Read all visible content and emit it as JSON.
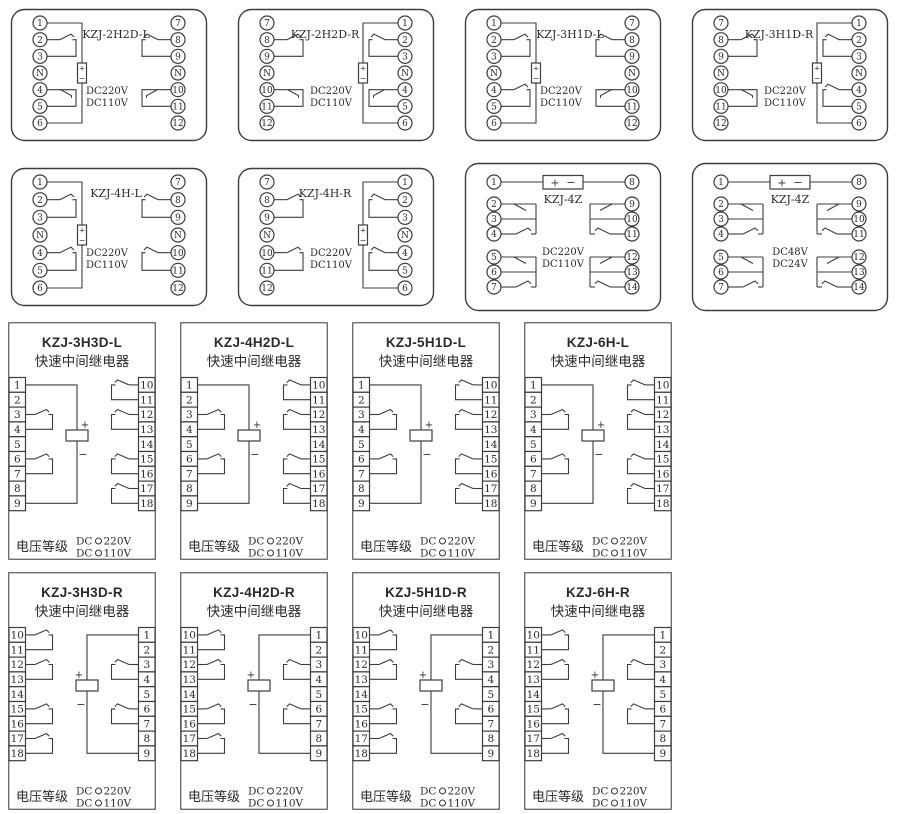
{
  "page": {
    "background": "#ffffff",
    "line_color": "#3c3c3c",
    "text_color": "#2b2b2b"
  },
  "rows": [
    {
      "y": 8,
      "xs": [
        10,
        237,
        464,
        691
      ],
      "panels": [
        {
          "kind": "round",
          "orient": "L",
          "w": 198,
          "h": 134,
          "dy": 0,
          "title": "KZJ-2H2D-L",
          "voltages": [
            "DC220V",
            "DC110V"
          ],
          "left_terminals": [
            "1",
            "2",
            "3",
            "N",
            "4",
            "5",
            "6"
          ],
          "right_terminals": [
            "7",
            "8",
            "9",
            "N",
            "10",
            "11",
            "12"
          ],
          "left_contacts": [
            {
              "rows": [
                1,
                2
              ],
              "type": "no"
            },
            {
              "rows": [
                4,
                5
              ],
              "type": "nc"
            }
          ],
          "right_contacts": [
            {
              "rows": [
                1,
                2
              ],
              "type": "no"
            },
            {
              "rows": [
                4,
                5
              ],
              "type": "nc"
            }
          ]
        },
        {
          "kind": "round",
          "orient": "R",
          "w": 198,
          "h": 134,
          "dy": 0,
          "title": "KZJ-2H2D-R",
          "voltages": [
            "DC220V",
            "DC110V"
          ],
          "left_terminals": [
            "7",
            "8",
            "9",
            "N",
            "10",
            "11",
            "12"
          ],
          "right_terminals": [
            "1",
            "2",
            "3",
            "N",
            "4",
            "5",
            "6"
          ],
          "left_contacts": [
            {
              "rows": [
                1,
                2
              ],
              "type": "no"
            },
            {
              "rows": [
                4,
                5
              ],
              "type": "nc"
            }
          ],
          "right_contacts": [
            {
              "rows": [
                1,
                2
              ],
              "type": "no"
            },
            {
              "rows": [
                4,
                5
              ],
              "type": "nc"
            }
          ]
        },
        {
          "kind": "round",
          "orient": "L",
          "w": 198,
          "h": 134,
          "dy": 0,
          "title": "KZJ-3H1D-L",
          "voltages": [
            "DC220V",
            "DC110V"
          ],
          "left_terminals": [
            "1",
            "2",
            "3",
            "N",
            "4",
            "5",
            "6"
          ],
          "right_terminals": [
            "7",
            "8",
            "9",
            "N",
            "10",
            "11",
            "12"
          ],
          "left_contacts": [
            {
              "rows": [
                1,
                2
              ],
              "type": "no"
            },
            {
              "rows": [
                4,
                5
              ],
              "type": "no"
            }
          ],
          "right_contacts": [
            {
              "rows": [
                1,
                2
              ],
              "type": "no"
            },
            {
              "rows": [
                4,
                5
              ],
              "type": "nc"
            }
          ]
        },
        {
          "kind": "round",
          "orient": "R",
          "w": 198,
          "h": 134,
          "dy": 0,
          "title": "KZJ-3H1D-R",
          "voltages": [
            "DC220V",
            "DC110V"
          ],
          "left_terminals": [
            "7",
            "8",
            "9",
            "N",
            "10",
            "11",
            "12"
          ],
          "right_terminals": [
            "1",
            "2",
            "3",
            "N",
            "4",
            "5",
            "6"
          ],
          "left_contacts": [
            {
              "rows": [
                1,
                2
              ],
              "type": "no"
            },
            {
              "rows": [
                4,
                5
              ],
              "type": "nc"
            }
          ],
          "right_contacts": [
            {
              "rows": [
                1,
                2
              ],
              "type": "no"
            },
            {
              "rows": [
                4,
                5
              ],
              "type": "no"
            }
          ]
        }
      ]
    },
    {
      "y": 162,
      "xs": [
        10,
        237,
        464,
        691
      ],
      "panels": [
        {
          "kind": "round",
          "orient": "L",
          "w": 198,
          "h": 140,
          "dy": 5,
          "title": "KZJ-4H-L",
          "voltages": [
            "DC220V",
            "DC110V"
          ],
          "left_terminals": [
            "1",
            "2",
            "3",
            "N",
            "4",
            "5",
            "6"
          ],
          "right_terminals": [
            "7",
            "8",
            "9",
            "N",
            "10",
            "11",
            "12"
          ],
          "left_contacts": [
            {
              "rows": [
                1,
                2
              ],
              "type": "no"
            },
            {
              "rows": [
                4,
                5
              ],
              "type": "no"
            }
          ],
          "right_contacts": [
            {
              "rows": [
                1,
                2
              ],
              "type": "no"
            },
            {
              "rows": [
                4,
                5
              ],
              "type": "no"
            }
          ]
        },
        {
          "kind": "round",
          "orient": "R",
          "w": 198,
          "h": 140,
          "dy": 5,
          "title": "KZJ-4H-R",
          "voltages": [
            "DC220V",
            "DC110V"
          ],
          "left_terminals": [
            "7",
            "8",
            "9",
            "N",
            "10",
            "11",
            "12"
          ],
          "right_terminals": [
            "1",
            "2",
            "3",
            "N",
            "4",
            "5",
            "6"
          ],
          "left_contacts": [
            {
              "rows": [
                1,
                2
              ],
              "type": "no"
            },
            {
              "rows": [
                4,
                5
              ],
              "type": "no"
            }
          ],
          "right_contacts": [
            {
              "rows": [
                1,
                2
              ],
              "type": "no"
            },
            {
              "rows": [
                4,
                5
              ],
              "type": "no"
            }
          ]
        },
        {
          "kind": "fourz",
          "w": 198,
          "h": 150,
          "dy": 0,
          "title": "KZJ-4Z",
          "voltages": [
            "DC220V",
            "DC110V"
          ],
          "left_terminals": [
            "1",
            "2",
            "3",
            "4",
            "5",
            "6",
            "7"
          ],
          "right_terminals": [
            "8",
            "9",
            "10",
            "11",
            "12",
            "13",
            "14"
          ]
        },
        {
          "kind": "fourz",
          "w": 198,
          "h": 150,
          "dy": 0,
          "title": "KZJ-4Z",
          "voltages": [
            "DC48V",
            "DC24V"
          ],
          "left_terminals": [
            "1",
            "2",
            "3",
            "4",
            "5",
            "6",
            "7"
          ],
          "right_terminals": [
            "8",
            "9",
            "10",
            "11",
            "12",
            "13",
            "14"
          ]
        }
      ]
    },
    {
      "y": 322,
      "xs": [
        8,
        180,
        352,
        524
      ],
      "panels": [
        {
          "kind": "square",
          "orient": "L",
          "w": 148,
          "h": 238,
          "dy": 0,
          "title": "KZJ-3H3D-L",
          "subtitle": "快速中间继电器",
          "left_terminals": [
            "1",
            "2",
            "3",
            "4",
            "5",
            "6",
            "7",
            "8",
            "9"
          ],
          "right_terminals": [
            "10",
            "11",
            "12",
            "13",
            "14",
            "15",
            "16",
            "17",
            "18"
          ],
          "legend": {
            "label": "电压等级",
            "options": [
              {
                "prefix": "DC",
                "value": "220V"
              },
              {
                "prefix": "DC",
                "value": "110V"
              }
            ]
          }
        },
        {
          "kind": "square",
          "orient": "L",
          "w": 148,
          "h": 238,
          "dy": 0,
          "title": "KZJ-4H2D-L",
          "subtitle": "快速中间继电器",
          "left_terminals": [
            "1",
            "2",
            "3",
            "4",
            "5",
            "6",
            "7",
            "8",
            "9"
          ],
          "right_terminals": [
            "10",
            "11",
            "12",
            "13",
            "14",
            "15",
            "16",
            "17",
            "18"
          ],
          "legend": {
            "label": "电压等级",
            "options": [
              {
                "prefix": "DC",
                "value": "220V"
              },
              {
                "prefix": "DC",
                "value": "110V"
              }
            ]
          }
        },
        {
          "kind": "square",
          "orient": "L",
          "w": 148,
          "h": 238,
          "dy": 0,
          "title": "KZJ-5H1D-L",
          "subtitle": "快速中间继电器",
          "left_terminals": [
            "1",
            "2",
            "3",
            "4",
            "5",
            "6",
            "7",
            "8",
            "9"
          ],
          "right_terminals": [
            "10",
            "11",
            "12",
            "13",
            "14",
            "15",
            "16",
            "17",
            "18"
          ],
          "legend": {
            "label": "电压等级",
            "options": [
              {
                "prefix": "DC",
                "value": "220V"
              },
              {
                "prefix": "DC",
                "value": "110V"
              }
            ]
          }
        },
        {
          "kind": "square",
          "orient": "L",
          "w": 148,
          "h": 238,
          "dy": 0,
          "title": "KZJ-6H-L",
          "subtitle": "快速中间继电器",
          "left_terminals": [
            "1",
            "2",
            "3",
            "4",
            "5",
            "6",
            "7",
            "8",
            "9"
          ],
          "right_terminals": [
            "10",
            "11",
            "12",
            "13",
            "14",
            "15",
            "16",
            "17",
            "18"
          ],
          "legend": {
            "label": "电压等级",
            "options": [
              {
                "prefix": "DC",
                "value": "220V"
              },
              {
                "prefix": "DC",
                "value": "110V"
              }
            ]
          }
        }
      ]
    },
    {
      "y": 572,
      "xs": [
        8,
        180,
        352,
        524
      ],
      "panels": [
        {
          "kind": "square",
          "orient": "R",
          "w": 148,
          "h": 238,
          "dy": 0,
          "title": "KZJ-3H3D-R",
          "subtitle": "快速中间继电器",
          "left_terminals": [
            "10",
            "11",
            "12",
            "13",
            "14",
            "15",
            "16",
            "17",
            "18"
          ],
          "right_terminals": [
            "1",
            "2",
            "3",
            "4",
            "5",
            "6",
            "7",
            "8",
            "9"
          ],
          "legend": {
            "label": "电压等级",
            "options": [
              {
                "prefix": "DC",
                "value": "220V"
              },
              {
                "prefix": "DC",
                "value": "110V"
              }
            ]
          }
        },
        {
          "kind": "square",
          "orient": "R",
          "w": 148,
          "h": 238,
          "dy": 0,
          "title": "KZJ-4H2D-R",
          "subtitle": "快速中间继电器",
          "left_terminals": [
            "10",
            "11",
            "12",
            "13",
            "14",
            "15",
            "16",
            "17",
            "18"
          ],
          "right_terminals": [
            "1",
            "2",
            "3",
            "4",
            "5",
            "6",
            "7",
            "8",
            "9"
          ],
          "legend": {
            "label": "电压等级",
            "options": [
              {
                "prefix": "DC",
                "value": "220V"
              },
              {
                "prefix": "DC",
                "value": "110V"
              }
            ]
          }
        },
        {
          "kind": "square",
          "orient": "R",
          "w": 148,
          "h": 238,
          "dy": 0,
          "title": "KZJ-5H1D-R",
          "subtitle": "快速中间继电器",
          "left_terminals": [
            "10",
            "11",
            "12",
            "13",
            "14",
            "15",
            "16",
            "17",
            "18"
          ],
          "right_terminals": [
            "1",
            "2",
            "3",
            "4",
            "5",
            "6",
            "7",
            "8",
            "9"
          ],
          "legend": {
            "label": "电压等级",
            "options": [
              {
                "prefix": "DC",
                "value": "220V"
              },
              {
                "prefix": "DC",
                "value": "110V"
              }
            ]
          }
        },
        {
          "kind": "square",
          "orient": "R",
          "w": 148,
          "h": 238,
          "dy": 0,
          "title": "KZJ-6H-R",
          "subtitle": "快速中间继电器",
          "left_terminals": [
            "10",
            "11",
            "12",
            "13",
            "14",
            "15",
            "16",
            "17",
            "18"
          ],
          "right_terminals": [
            "1",
            "2",
            "3",
            "4",
            "5",
            "6",
            "7",
            "8",
            "9"
          ],
          "legend": {
            "label": "电压等级",
            "options": [
              {
                "prefix": "DC",
                "value": "220V"
              },
              {
                "prefix": "DC",
                "value": "110V"
              }
            ]
          }
        }
      ]
    }
  ]
}
